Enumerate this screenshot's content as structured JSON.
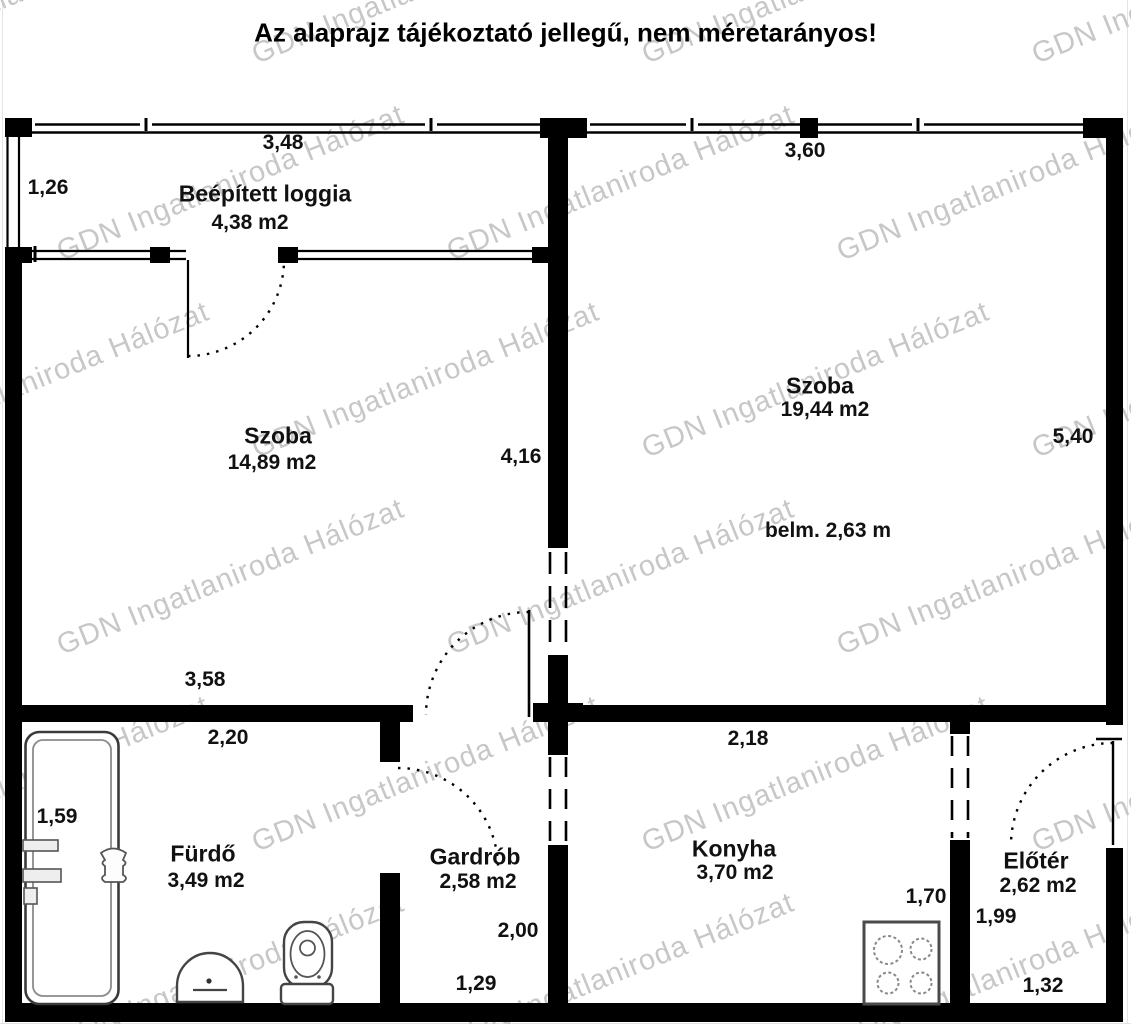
{
  "title": "Az alaprajz tájékoztató jellegű, nem méretarányos!",
  "watermark": {
    "text": "GDN Ingatlaniroda Hálózat",
    "color": "#c7c7c7"
  },
  "colors": {
    "wall": "#000000",
    "fixture_stroke": "#4a4a4a",
    "text": "#111111"
  },
  "rooms": {
    "loggia": {
      "name": "Beépített loggia",
      "area": "4,38 m2"
    },
    "szoba_left": {
      "name": "Szoba",
      "area": "14,89 m2"
    },
    "szoba_right": {
      "name": "Szoba",
      "area": "19,44 m2",
      "note": "belm. 2,63 m"
    },
    "furdo": {
      "name": "Fürdő",
      "area": "3,49 m2"
    },
    "gardrob": {
      "name": "Gardrób",
      "area": "2,58 m2"
    },
    "konyha": {
      "name": "Konyha",
      "area": "3,70 m2"
    },
    "eloter": {
      "name": "Előtér",
      "area": "2,62 m2"
    }
  },
  "dimensions": {
    "loggia_width": "3,48",
    "loggia_depth": "1,26",
    "szoba_right_width": "3,60",
    "szoba_right_depth": "5,40",
    "szoba_left_depth": "4,16",
    "szoba_left_width": "3,58",
    "furdo_width": "2,20",
    "furdo_depth": "1,59",
    "konyha_width": "2,18",
    "konyha_right": "1,70",
    "gardrob_depth": "2,00",
    "gardrob_width": "1,29",
    "eloter_depth": "1,99",
    "eloter_width": "1,32"
  }
}
